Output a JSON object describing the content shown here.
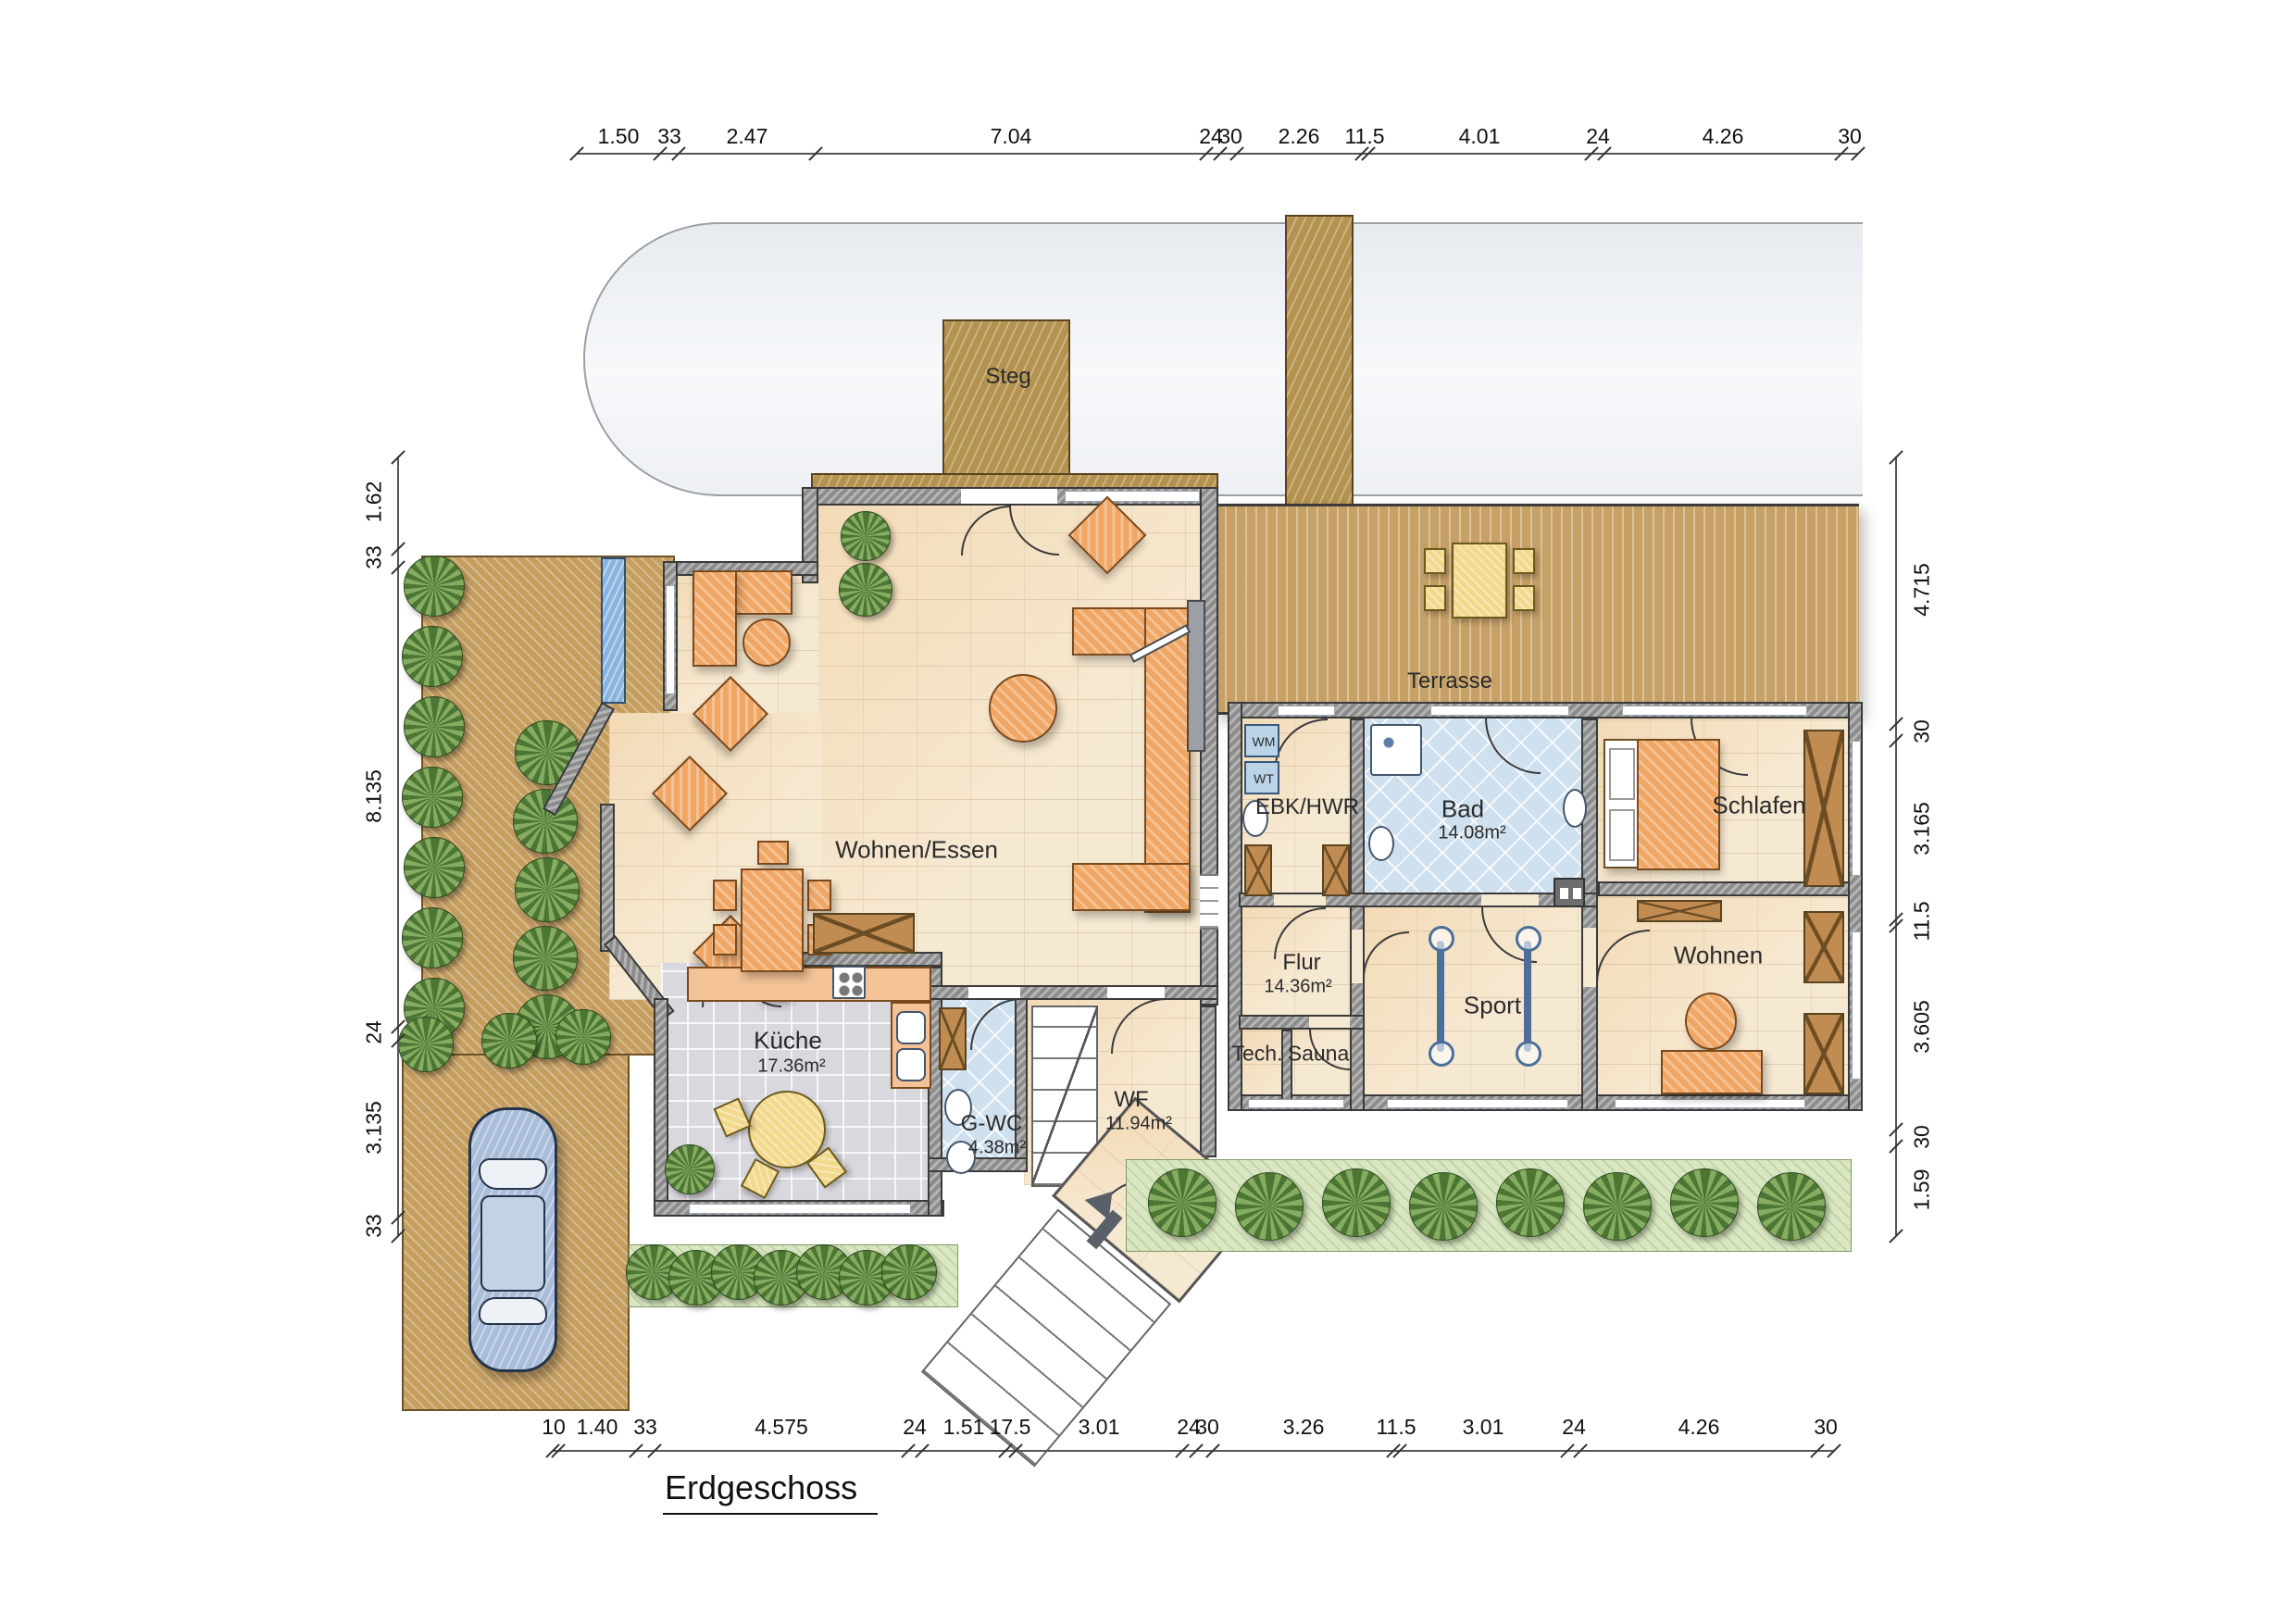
{
  "title": {
    "text": "Erdgeschoss"
  },
  "outdoor": {
    "steg_label": "Steg",
    "terrasse_label": "Terrasse"
  },
  "rooms": {
    "wohnen_essen": {
      "name": "Wohnen/Essen"
    },
    "kueche": {
      "name": "Küche",
      "area": "17.36m²"
    },
    "g_wc": {
      "name": "G-WC",
      "area": "4.38m²"
    },
    "wf": {
      "name": "WF",
      "area": "11.94m²"
    },
    "ebk_hwr": {
      "name": "EBK/HWR"
    },
    "bad": {
      "name": "Bad",
      "area": "14.08m²"
    },
    "schlafen": {
      "name": "Schlafen"
    },
    "flur": {
      "name": "Flur",
      "area": "14.36m²"
    },
    "tech": {
      "name": "Tech."
    },
    "sauna": {
      "name": "Sauna"
    },
    "sport": {
      "name": "Sport"
    },
    "wohnen": {
      "name": "Wohnen"
    }
  },
  "appliances": {
    "wm": "WM",
    "wt": "WT"
  },
  "dimensions": {
    "top": [
      "1.50",
      "33",
      "2.47",
      "7.04",
      "24",
      "30",
      "2.26",
      "11.5",
      "4.01",
      "24",
      "4.26",
      "30"
    ],
    "bottom": [
      "10",
      "1.40",
      "33",
      "4.575",
      "24",
      "1.51",
      "17.5",
      "3.01",
      "24",
      "30",
      "3.26",
      "11.5",
      "3.01",
      "24",
      "4.26",
      "30"
    ],
    "left": [
      "1.62",
      "33",
      "8.135",
      "24",
      "3.135",
      "33"
    ],
    "right": [
      "4.715",
      "30",
      "3.165",
      "11.5",
      "3.605",
      "30",
      "1.59"
    ]
  },
  "colors": {
    "wood": "#b4924f",
    "terrace": "#c7a066",
    "floor": "#f6e9d2",
    "wall": "#8c8c8c",
    "water": "#e9edf2",
    "bath_tile": "#cfe0ee",
    "hedge_green": "#5f8a4a",
    "furniture_orange": "#f0a765",
    "car_blue": "#a9bdd9",
    "accent_yellow": "#f2d98c"
  }
}
